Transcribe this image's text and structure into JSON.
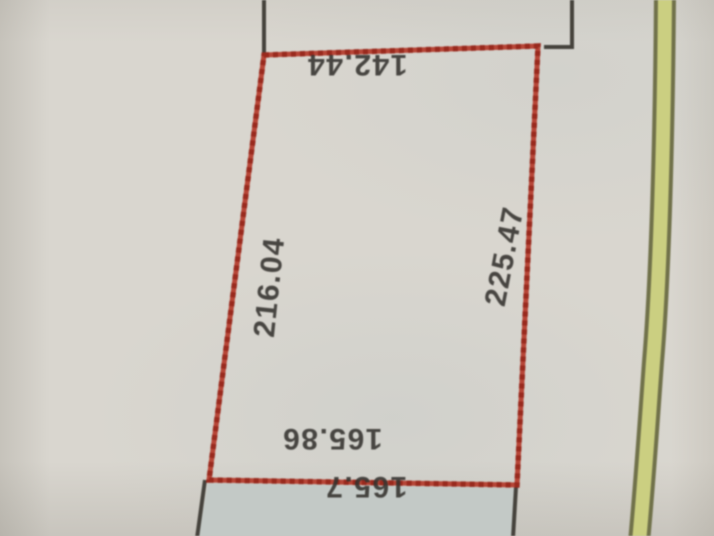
{
  "document": {
    "kind": "survey-plat-photo",
    "description": "Photographed survey plat showing a parcel outlined with a red dashed boundary, adjacent parcel lines in black, a shaded adjacent parcel below, and a highlighted road line at right"
  },
  "measurements": {
    "top": "142.44",
    "left": "216.04",
    "right": "225.47",
    "bottom_inner": "165.86",
    "bottom": "165.7"
  },
  "colors": {
    "paper": "#d9d6cf",
    "boundary_red": "#b4392a",
    "boundary_red_dark": "#93251a",
    "line_black": "#45423c",
    "road_edge": "#70714a",
    "road_fill": "#cbcf81",
    "shade_fill": "#c3c9c6",
    "text": "#34322e"
  }
}
